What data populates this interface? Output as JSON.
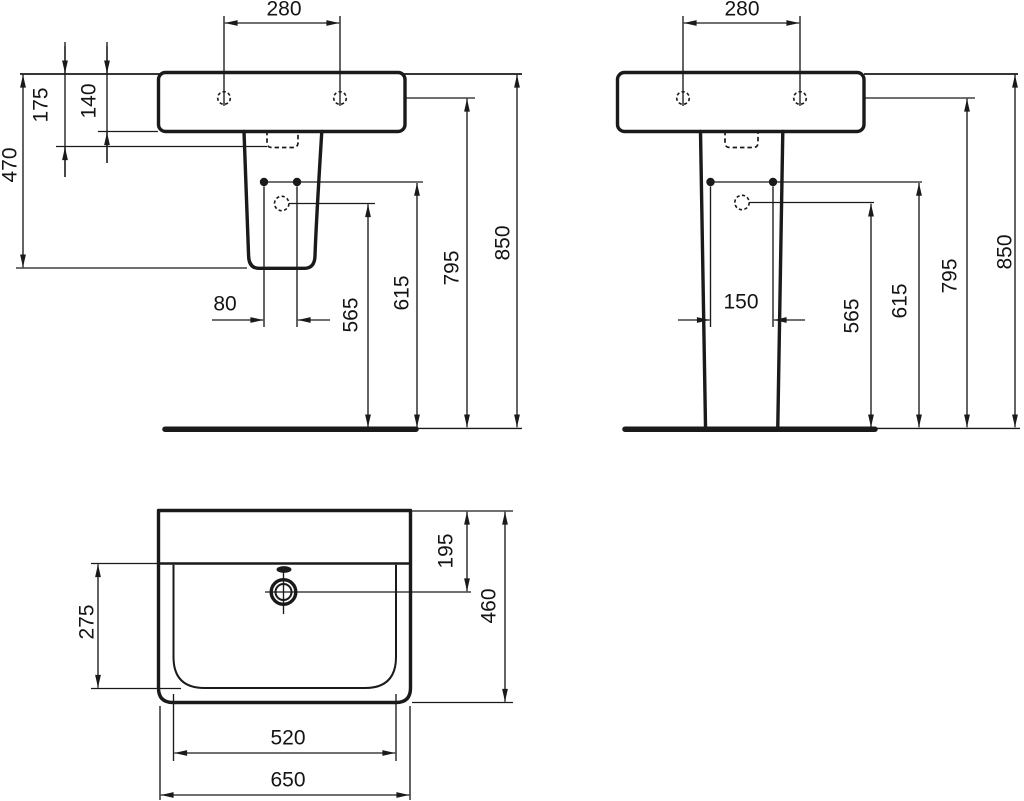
{
  "title": "Washbasin with pedestal - dimensional drawing (mm)",
  "colors": {
    "background": "#ffffff",
    "line": "#1a1a1a"
  },
  "views": {
    "side": {
      "name": "side view",
      "dims": {
        "d280": "280",
        "d175": "175",
        "d140": "140",
        "d470": "470",
        "d80": "80",
        "d565": "565",
        "d615": "615",
        "d795": "795",
        "d850": "850"
      }
    },
    "front": {
      "name": "front view",
      "dims": {
        "d280": "280",
        "d150": "150",
        "d565": "565",
        "d615": "615",
        "d795": "795",
        "d850": "850"
      }
    },
    "plan": {
      "name": "plan view",
      "dims": {
        "d195": "195",
        "d275": "275",
        "d460": "460",
        "d520": "520",
        "d650": "650"
      }
    }
  }
}
